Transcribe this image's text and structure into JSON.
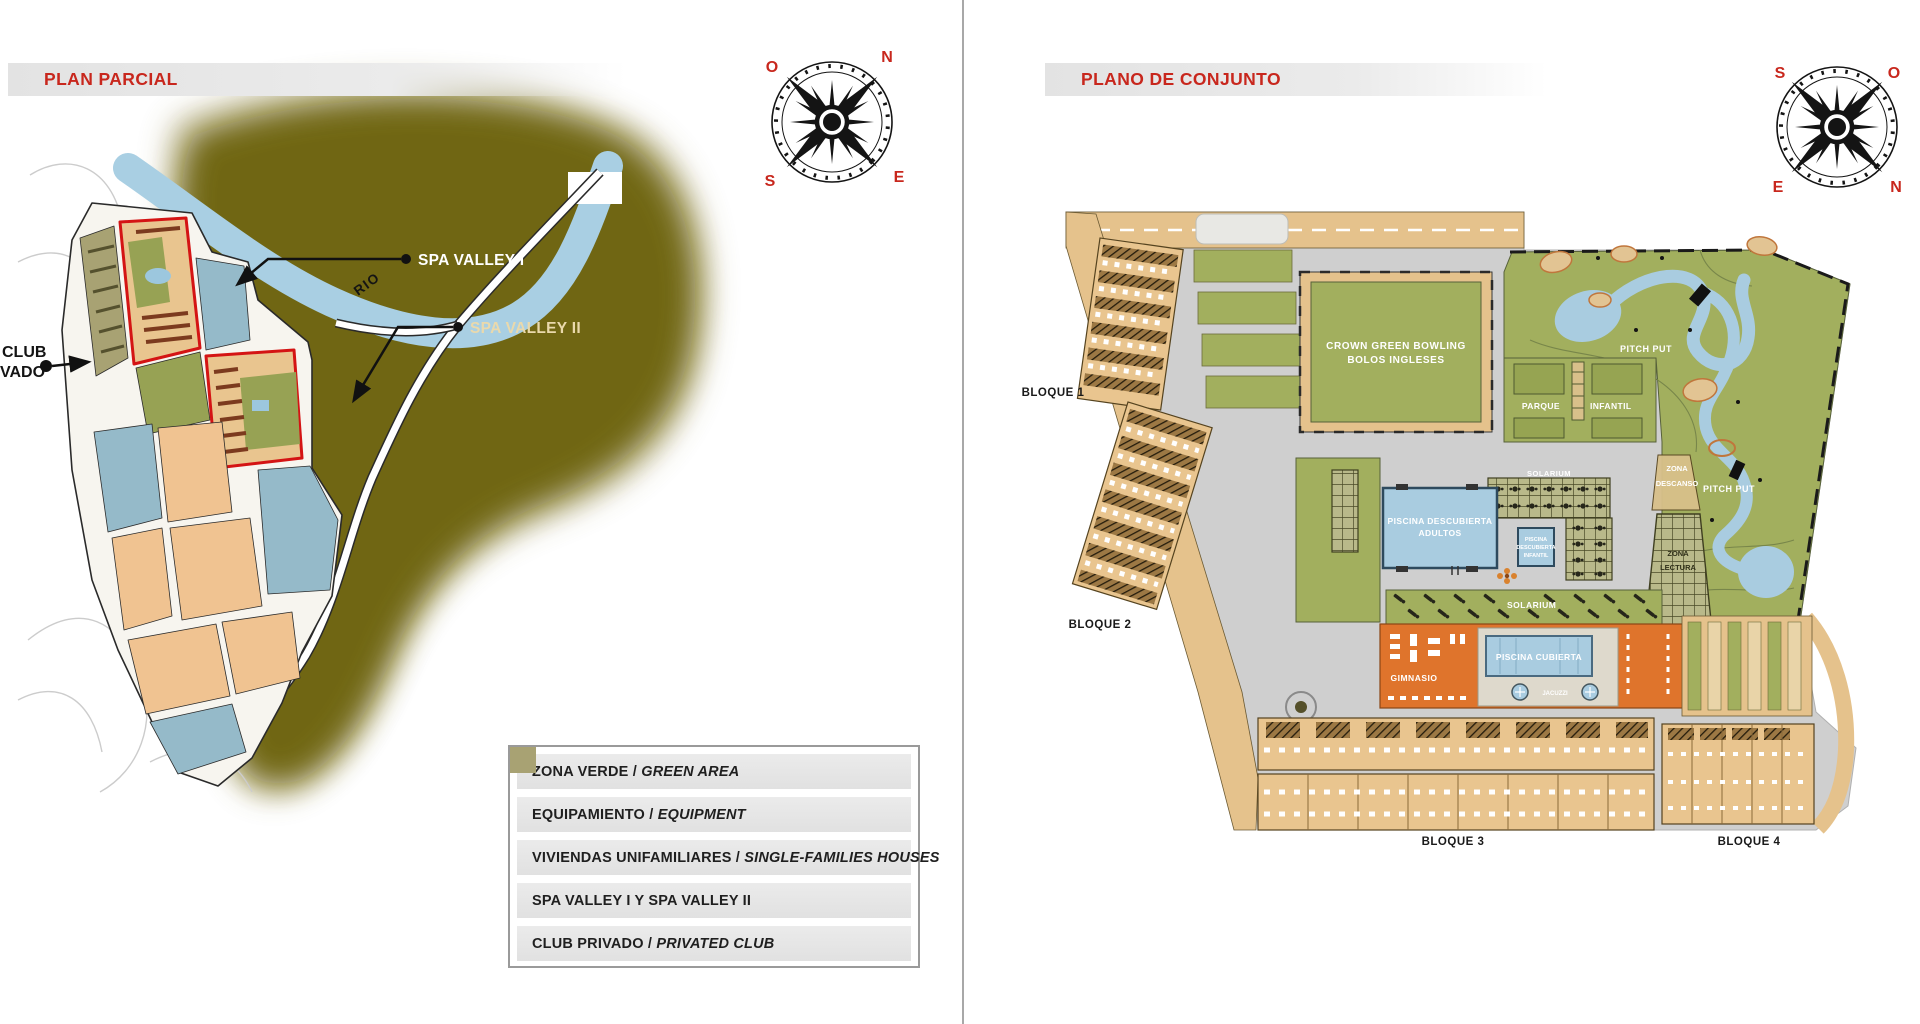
{
  "palette": {
    "title_red": "#c8271d",
    "terrain_olive": "#6d6310",
    "river_blue": "#a9cfe3",
    "plan_green": "#a2af5e",
    "building_tan": "#e9c58f",
    "pool_blue": "#a9cce0",
    "gym_orange": "#df742c",
    "path_gray": "#cfcfcf"
  },
  "left_page": {
    "title": "PLAN PARCIAL",
    "compass": {
      "n": "N",
      "o": "O",
      "e": "E",
      "s": "S"
    },
    "map_labels": {
      "rio": "RIO",
      "spa_valley_1": "SPA VALLEY I",
      "spa_valley_2": "SPA VALLEY II",
      "club_line1": "CLUB",
      "club_line2": "VADO"
    },
    "legend": {
      "items": [
        {
          "label_es": "ZONA VERDE /",
          "label_en": "GREEN AREA",
          "color": "#97a254"
        },
        {
          "label_es": "EQUIPAMIENTO /",
          "label_en": "EQUIPMENT",
          "color": "#95bac9"
        },
        {
          "label_es": "VIVIENDAS UNIFAMILIARES /",
          "label_en": "SINGLE-FAMILIES HOUSES",
          "color": "#f0c391"
        },
        {
          "label_es": "SPA VALLEY I Y SPA VALLEY II",
          "label_en": "",
          "color": "#e31818"
        },
        {
          "label_es": "CLUB PRIVADO /",
          "label_en": "PRIVATED CLUB",
          "color": "#a8a273"
        }
      ]
    }
  },
  "right_page": {
    "title": "PLANO DE CONJUNTO",
    "compass": {
      "n": "N",
      "o": "O",
      "e": "E",
      "s": "S"
    },
    "blocks": {
      "b1": "BLOQUE 1",
      "b2": "BLOQUE 2",
      "b3": "BLOQUE 3",
      "b4": "BLOQUE 4"
    },
    "areas": {
      "bowling_line1": "CROWN GREEN BOWLING",
      "bowling_line2": "BOLOS INGLESES",
      "parque_line1": "PARQUE",
      "parque_line2": "INFANTIL",
      "pitch_put_upper": "PITCH PUT",
      "pitch_put_lower": "PITCH PUT",
      "zona_descanso_line1": "ZONA",
      "zona_descanso_line2": "DESCANSO",
      "zona_lectura_line1": "ZONA",
      "zona_lectura_line2": "LECTURA",
      "solarium_terrace": "SOLARIUM",
      "solarium_strip": "SOLARIUM",
      "piscina_adultos_line1": "PISCINA DESCUBIERTA",
      "piscina_adultos_line2": "ADULTOS",
      "piscina_infantil_line1": "PISCINA",
      "piscina_infantil_line2": "DESCUBIERTA",
      "piscina_infantil_line3": "INFANTIL",
      "gimnasio": "GIMNASIO",
      "piscina_cubierta": "PISCINA CUBIERTA",
      "jacuzzi": "JACUZZI"
    }
  }
}
